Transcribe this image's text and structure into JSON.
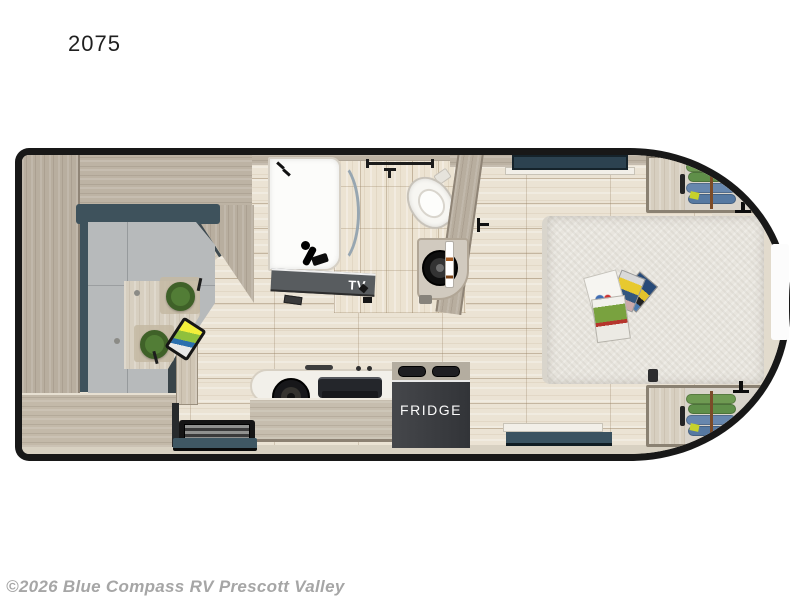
{
  "title": "2075",
  "floorplan": {
    "labels": {
      "tv": "TV",
      "fridge": "FRIDGE"
    }
  },
  "watermark": "©2026 Blue Compass RV Prescott Valley",
  "colors": {
    "outline_black": "#181818",
    "wall_wood": "#bdb3a4",
    "floor_tile": "#ebe3d4",
    "sofa_cushion": "#b7babb",
    "sofa_backrest": "#3e525c",
    "window_slate": "#2c4250",
    "stool_green": "#4e7733",
    "fridge_dark": "#3a3c3f",
    "clothes_green": "#6e9a52",
    "clothes_blue": "#6787ae"
  }
}
